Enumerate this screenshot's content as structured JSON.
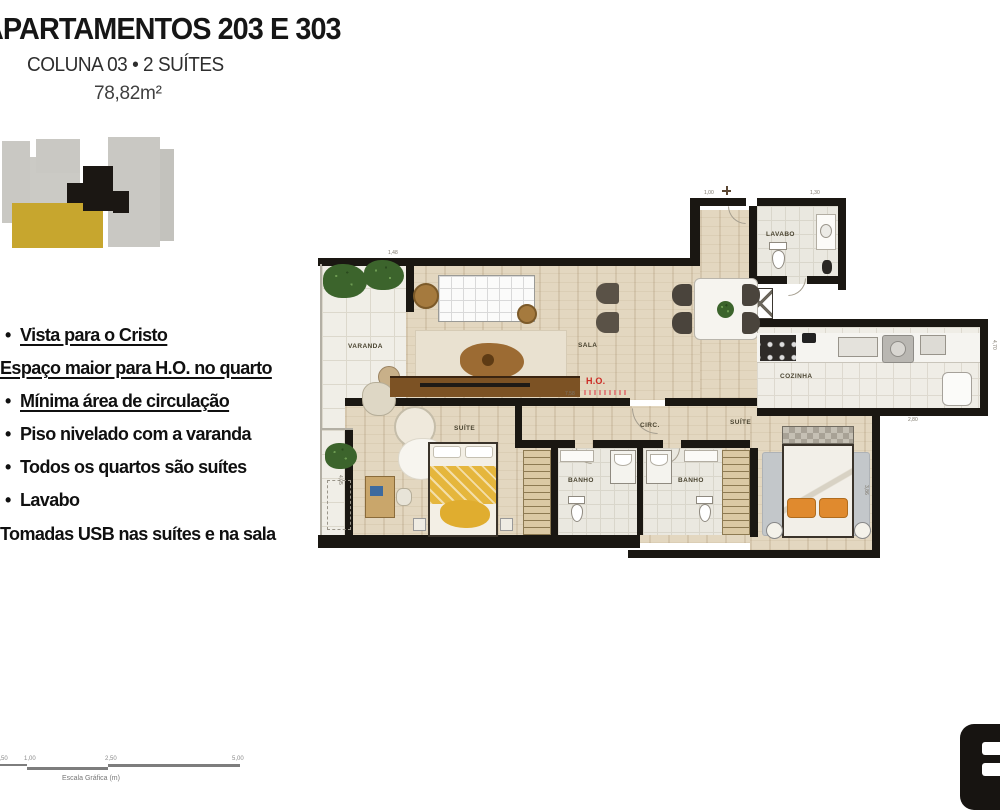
{
  "header": {
    "title": "APARTAMENTOS 203 E 303",
    "subtitle": "COLUNA 03 • 2 SUÍTES",
    "area": "78,82m²"
  },
  "keyplan": {
    "unit_color": "#c7a62e",
    "floor_color": "#c9c8c3",
    "core_color": "#1b1713"
  },
  "features": {
    "items": [
      {
        "text": "Vista para o Cristo"
      },
      {
        "text": "Espaço maior para H.O. no quarto"
      },
      {
        "text": "Mínima área de circulação"
      },
      {
        "text": "Piso nivelado com a varanda"
      },
      {
        "text": "Todos os quartos são suítes"
      },
      {
        "text": "Lavabo"
      },
      {
        "text": "Tomadas USB nas suítes e na sala"
      }
    ]
  },
  "plan": {
    "ho_color": "#cc2a24",
    "wall_color": "#1a1712",
    "rooms": {
      "varanda": "VARANDA",
      "sala": "SALA",
      "ho": "H.O.",
      "cozinha": "COZINHA",
      "lavabo": "LAVABO",
      "circ": "CIRC.",
      "suite1": "SUÍTE",
      "banho1": "BANHO",
      "banho2": "BANHO",
      "suite2": "SUÍTE"
    },
    "dims": [
      {
        "t": "1,48"
      },
      {
        "t": "1,00"
      },
      {
        "t": "1,30"
      },
      {
        "t": "4,70"
      },
      {
        "t": "2,80"
      },
      {
        "t": "4,05"
      },
      {
        "t": "3,86"
      },
      {
        "t": "7,58"
      }
    ]
  },
  "scalebar": {
    "ticks": [
      "0,50",
      "1,00",
      "2,50",
      "5,00"
    ],
    "caption": "Escala Gráfica (m)"
  }
}
